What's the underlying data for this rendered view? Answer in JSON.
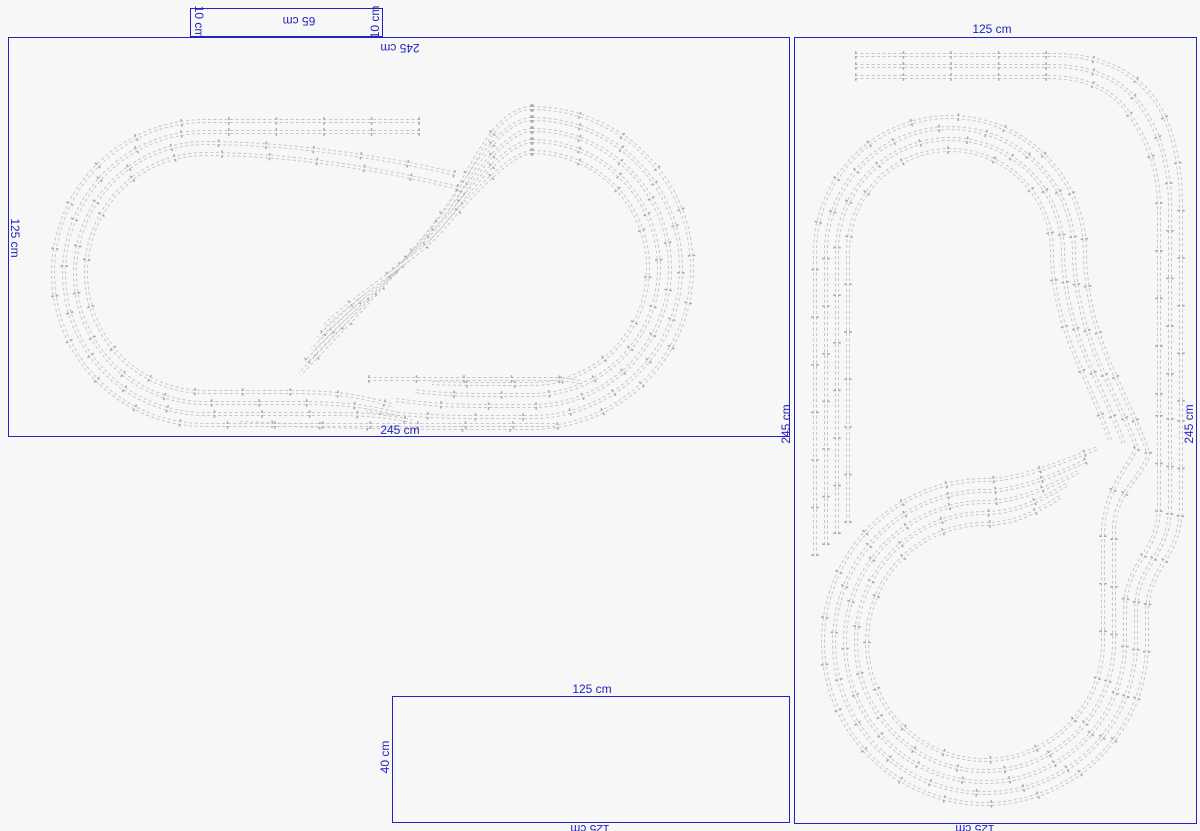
{
  "app": {
    "background": "#f7f7f7",
    "outline_blue": "#2222bd",
    "label_blue": "#2222bd"
  },
  "boards": [
    {
      "name": "spare-board-65x10",
      "x": 190,
      "y": 8,
      "w": 193,
      "h": 29
    },
    {
      "name": "main-board-245x125",
      "x": 8,
      "y": 37,
      "w": 782,
      "h": 400
    },
    {
      "name": "main-board-125x245",
      "x": 794,
      "y": 37,
      "w": 403,
      "h": 787
    },
    {
      "name": "extension-board-125x40",
      "x": 392,
      "y": 696,
      "w": 398,
      "h": 127
    }
  ],
  "labels": [
    {
      "text": "65 cm",
      "x": 299,
      "y": 21,
      "rot": 180
    },
    {
      "text": "10 cm",
      "x": 199,
      "y": 22,
      "rot": 90
    },
    {
      "text": "10 cm",
      "x": 375,
      "y": 22,
      "rot": -90
    },
    {
      "text": "245 cm",
      "x": 400,
      "y": 48,
      "rot": 180
    },
    {
      "text": "125 cm",
      "x": 15,
      "y": 238,
      "rot": 90
    },
    {
      "text": "245 cm",
      "x": 400,
      "y": 430,
      "rot": 0
    },
    {
      "text": "245 cm",
      "x": 786,
      "y": 424,
      "rot": -90
    },
    {
      "text": "245 cm",
      "x": 1189,
      "y": 424,
      "rot": -90
    },
    {
      "text": "125 cm",
      "x": 992,
      "y": 29,
      "rot": 0
    },
    {
      "text": "125 cm",
      "x": 592,
      "y": 689,
      "rot": 0
    },
    {
      "text": "40 cm",
      "x": 385,
      "y": 757,
      "rot": -90
    },
    {
      "text": "125 cm",
      "x": 590,
      "y": 829,
      "rot": 180
    },
    {
      "text": "125 cm",
      "x": 975,
      "y": 829,
      "rot": 180
    }
  ],
  "track_style": {
    "rail": "#c7c7c7",
    "tie": "#ababab",
    "core": "#f7f7f7",
    "railWidth": 4,
    "coreWidth": 2,
    "tieWidth": 7.5,
    "dash": "3 2.5",
    "tieDash": "1.6 46"
  },
  "tracks": {
    "left_board": [
      "M 532 108 A 160 160 0 0 1 692 268 A 160 160 0 0 1 532 428 L 470 428 C 420 428 330 427 240 423 M 532 108 C 494 108 468 176 450 203 C 420 248 360 312 300 374",
      "M 532 119 A 149 149 0 0 1 681 268 A 149 149 0 0 1 532 417 L 476 417 C 436 417 400 415 366 410 M 532 119 C 498 119 464 186 447 210 C 418 252 362 304 306 362",
      "M 532 130 A 138 138 0 0 1 670 268 A 138 138 0 0 1 532 406 L 482 406 C 448 406 424 404 396 400 M 532 130 C 502 130 461 196 445 218 C 416 255 365 297 312 350",
      "M 532 141 A 127 127 0 0 1 659 268 A 127 127 0 0 1 532 395 L 488 395 C 458 395 440 394 414 391 M 532 141 C 505 141 458 205 442 225 C 414 258 368 290 318 338",
      "M 532 152 A 116 116 0 0 1 648 268 A 116 116 0 0 1 532 384 L 494 384 C 470 384 452 384 432 383 M 532 152 C 508 152 455 214 440 232 C 412 262 370 284 324 326",
      "M 368 379 L 548 379 C 560 379 570 380 580 382",
      "M 420 121 L 205 121 A 152 152 0 0 0 53 273 A 152 152 0 0 0 205 425 L 555 425",
      "M 420 132 L 205 132 A 141 141 0 0 0 64 273 A 141 141 0 0 0 205 414 L 330 414 C 370 414 390 417 412 421",
      "M 455 174 C 390 158 290 143 205 143 A 130 130 0 0 0 75 273 A 130 130 0 0 0 205 403 L 300 403 C 350 403 375 408 398 414",
      "M 458 188 C 395 172 298 154 205 154 A 119 119 0 0 0 86 273 A 119 119 0 0 0 205 392 L 295 392 C 340 392 370 398 394 406"
    ],
    "right_board": [
      "M 1181 420 L 1181 505 C 1181 560 1147 565 1147 615 L 1147 642 A 162 162 0 0 1 985 804 A 162 162 0 0 1 823 642 A 162 162 0 0 1 985 480 C 1020 480 1062 462 1098 448",
      "M 1170 418 L 1170 505 C 1170 558 1136 562 1136 612 L 1136 642 A 151 151 0 0 1 985 793 A 151 151 0 0 1 834 642 A 151 151 0 0 1 985 491 C 1018 491 1055 475 1088 460",
      "M 1159 415 L 1159 505 C 1159 556 1125 560 1125 610 L 1125 642 A 140 140 0 0 1 985 782 A 140 140 0 0 1 845 642 A 140 140 0 0 1 985 502 C 1016 502 1048 488 1078 472",
      "M 1148 452 C 1150 470 1114 490 1114 530 L 1114 642 A 129 129 0 0 1 985 771 A 129 129 0 0 1 856 642 A 129 129 0 0 1 985 513 C 1014 513 1040 501 1068 484",
      "M 1137 448 C 1125 470 1103 495 1103 535 L 1103 642 A 118 118 0 0 1 985 760 A 118 118 0 0 1 867 642 A 118 118 0 0 1 985 524 C 1012 524 1034 514 1060 497",
      "M 855 55 L 1055 55 C 1105 55 1140 75 1158 105 C 1172 128 1180 160 1181 200 L 1181 420",
      "M 855 66 L 1052 66 C 1098 66 1128 84 1145 112 C 1160 135 1169 165 1170 202 L 1170 418",
      "M 855 77 L 1048 77 C 1092 77 1118 94 1133 120 C 1148 143 1158 168 1159 205 L 1159 415",
      "M 815 556 L 815 252 A 135 135 0 0 1 950 117 A 135 135 0 0 1 1085 252 C 1085 295 1098 340 1118 382 C 1130 408 1140 430 1148 452",
      "M 826 545 L 826 252 A 124 124 0 0 1 950 128 A 124 124 0 0 1 1074 252 C 1074 292 1086 335 1104 374 C 1116 400 1128 424 1137 448",
      "M 837 534 L 837 252 A 113 113 0 0 1 950 139 A 113 113 0 0 1 1063 252 C 1063 290 1074 330 1090 366 C 1102 392 1114 418 1124 444",
      "M 848 523 L 848 252 A 102 102 0 0 1 950 150 A 102 102 0 0 1 1052 252 C 1052 288 1062 325 1076 358 C 1088 385 1100 412 1110 440"
    ]
  }
}
